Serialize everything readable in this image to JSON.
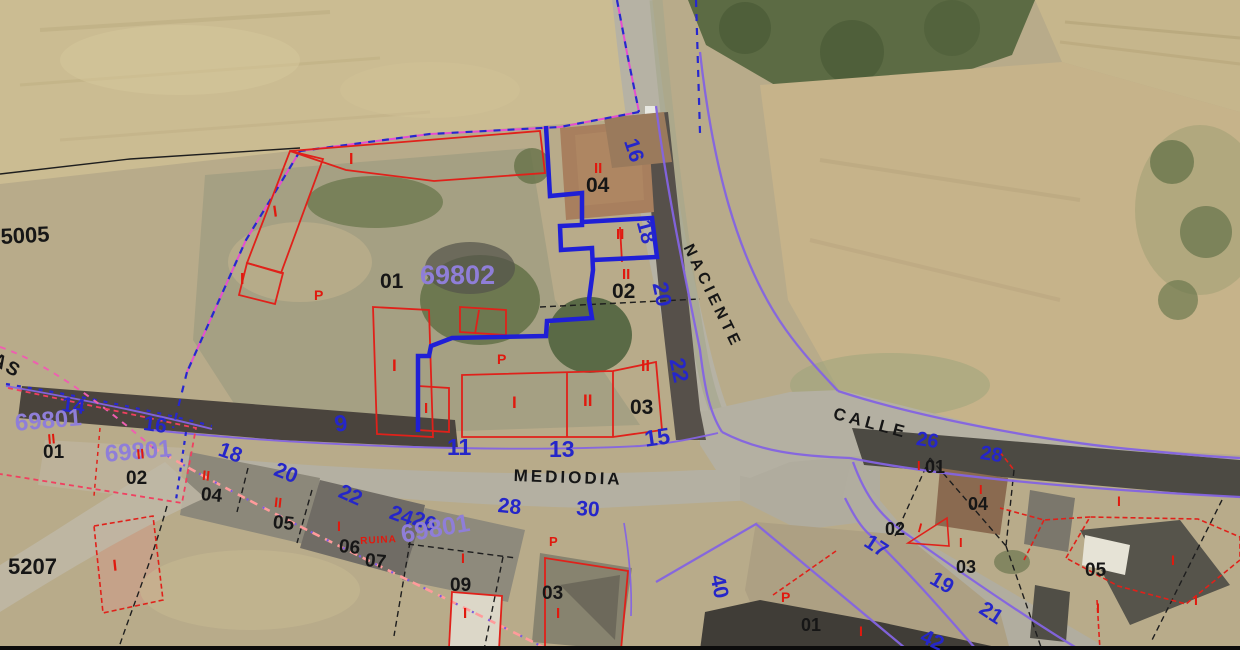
{
  "map": {
    "type": "cadastral-aerial-overlay",
    "palette": {
      "k": "#161616",
      "b": "#2526c9",
      "v": "#8f7ed8",
      "r": "#e0190e",
      "violet_line": "#8464e2",
      "blue_line": "#2727cf",
      "magenta_line": "#e54fd0",
      "pink_line": "#ff9b9b",
      "red_line": "#e0211a"
    },
    "labels": [
      {
        "n": "plot-number-5005",
        "t": "5005",
        "x": 0,
        "y": 226,
        "s": 22,
        "c": "k",
        "w": 600,
        "r": -3
      },
      {
        "n": "plot-number-5207",
        "t": "5207",
        "x": 8,
        "y": 556,
        "s": 22,
        "c": "k",
        "w": 600
      },
      {
        "n": "parcel-04-top",
        "t": "04",
        "x": 586,
        "y": 175,
        "s": 21,
        "c": "k",
        "w": 600
      },
      {
        "n": "parcel-02-top",
        "t": "02",
        "x": 612,
        "y": 281,
        "s": 21,
        "c": "k",
        "w": 600
      },
      {
        "n": "parcel-01-center",
        "t": "01",
        "x": 380,
        "y": 271,
        "s": 21,
        "c": "k",
        "w": 600
      },
      {
        "n": "parcel-03-center",
        "t": "03",
        "x": 630,
        "y": 397,
        "s": 21,
        "c": "k",
        "w": 600
      },
      {
        "n": "parcel-01-left",
        "t": "01",
        "x": 43,
        "y": 443,
        "s": 19,
        "c": "k",
        "w": 600
      },
      {
        "n": "parcel-02-left",
        "t": "02",
        "x": 126,
        "y": 469,
        "s": 19,
        "c": "k",
        "w": 600
      },
      {
        "n": "parcel-04-row",
        "t": "04",
        "x": 202,
        "y": 485,
        "s": 19,
        "c": "k",
        "w": 600,
        "r": 6
      },
      {
        "n": "parcel-05-row",
        "t": "05",
        "x": 274,
        "y": 513,
        "s": 19,
        "c": "k",
        "w": 600,
        "r": 6
      },
      {
        "n": "parcel-06-row",
        "t": "06",
        "x": 340,
        "y": 537,
        "s": 19,
        "c": "k",
        "w": 600,
        "r": 6
      },
      {
        "n": "parcel-07-row",
        "t": "07",
        "x": 366,
        "y": 551,
        "s": 19,
        "c": "k",
        "w": 600,
        "r": 6
      },
      {
        "n": "parcel-09-row",
        "t": "09",
        "x": 450,
        "y": 576,
        "s": 19,
        "c": "k",
        "w": 600
      },
      {
        "n": "parcel-03-row",
        "t": "03",
        "x": 542,
        "y": 584,
        "s": 19,
        "c": "k",
        "w": 600
      },
      {
        "n": "parcel-01-right",
        "t": "01",
        "x": 925,
        "y": 458,
        "s": 18,
        "c": "k",
        "w": 600
      },
      {
        "n": "parcel-04-right",
        "t": "04",
        "x": 968,
        "y": 495,
        "s": 18,
        "c": "k",
        "w": 600
      },
      {
        "n": "parcel-02-right",
        "t": "02",
        "x": 885,
        "y": 520,
        "s": 18,
        "c": "k",
        "w": 600
      },
      {
        "n": "parcel-03-right",
        "t": "03",
        "x": 956,
        "y": 558,
        "s": 18,
        "c": "k",
        "w": 600
      },
      {
        "n": "parcel-05-right",
        "t": "05",
        "x": 1085,
        "y": 561,
        "s": 19,
        "c": "k",
        "w": 600
      },
      {
        "n": "parcel-01-bottom",
        "t": "01",
        "x": 801,
        "y": 616,
        "s": 18,
        "c": "k",
        "w": 600
      },
      {
        "n": "street-name-naciente",
        "t": "NACIENTE",
        "x": 694,
        "y": 242,
        "s": 16,
        "c": "k",
        "w": 600,
        "r": 64,
        "ls": 4
      },
      {
        "n": "street-name-mediodia",
        "t": "MEDIODIA",
        "x": 514,
        "y": 467,
        "s": 17,
        "c": "k",
        "w": 600,
        "r": 2,
        "ls": 3
      },
      {
        "n": "street-name-calle",
        "t": "CALLE",
        "x": 836,
        "y": 405,
        "s": 17,
        "c": "k",
        "w": 600,
        "r": 15,
        "ls": 4
      },
      {
        "n": "street-name-partial",
        "t": "AS",
        "x": -2,
        "y": 350,
        "s": 19,
        "c": "k",
        "w": 600,
        "r": 30,
        "ls": 2
      },
      {
        "n": "house-number-16-naciente",
        "t": "16",
        "x": 640,
        "y": 136,
        "s": 21,
        "c": "b",
        "r": 72
      },
      {
        "n": "house-number-18-naciente",
        "t": "18",
        "x": 653,
        "y": 218,
        "s": 21,
        "c": "b",
        "r": 75
      },
      {
        "n": "house-number-20-naciente",
        "t": "20",
        "x": 670,
        "y": 280,
        "s": 22,
        "c": "b",
        "r": 78
      },
      {
        "n": "house-number-22-naciente",
        "t": "22",
        "x": 687,
        "y": 356,
        "s": 22,
        "c": "b",
        "r": 78
      },
      {
        "n": "house-number-9",
        "t": "9",
        "x": 333,
        "y": 413,
        "s": 23,
        "c": "b",
        "r": -8
      },
      {
        "n": "house-number-11",
        "t": "11",
        "x": 447,
        "y": 436,
        "s": 23,
        "c": "b"
      },
      {
        "n": "house-number-13",
        "t": "13",
        "x": 549,
        "y": 438,
        "s": 23,
        "c": "b"
      },
      {
        "n": "house-number-15",
        "t": "15",
        "x": 643,
        "y": 428,
        "s": 23,
        "c": "b",
        "r": -8
      },
      {
        "n": "house-number-14",
        "t": "14",
        "x": 63,
        "y": 394,
        "s": 21,
        "c": "b",
        "r": 8
      },
      {
        "n": "house-number-16-left",
        "t": "16",
        "x": 145,
        "y": 413,
        "s": 21,
        "c": "b",
        "r": 8
      },
      {
        "n": "house-number-18-row",
        "t": "18",
        "x": 223,
        "y": 439,
        "s": 21,
        "c": "b",
        "r": 20
      },
      {
        "n": "house-number-20-row",
        "t": "20",
        "x": 279,
        "y": 459,
        "s": 21,
        "c": "b",
        "r": 22
      },
      {
        "n": "house-number-22-row",
        "t": "22",
        "x": 344,
        "y": 481,
        "s": 21,
        "c": "b",
        "r": 24
      },
      {
        "n": "house-number-24",
        "t": "24",
        "x": 394,
        "y": 502,
        "s": 21,
        "c": "b",
        "r": 20
      },
      {
        "n": "house-number-26-row",
        "t": "26",
        "x": 417,
        "y": 508,
        "s": 21,
        "c": "b",
        "r": 20
      },
      {
        "n": "house-number-28-row",
        "t": "28",
        "x": 499,
        "y": 495,
        "s": 21,
        "c": "b",
        "r": 6
      },
      {
        "n": "house-number-30",
        "t": "30",
        "x": 577,
        "y": 498,
        "s": 21,
        "c": "b",
        "r": 4
      },
      {
        "n": "house-number-26-calle",
        "t": "26",
        "x": 918,
        "y": 429,
        "s": 20,
        "c": "b",
        "r": 9
      },
      {
        "n": "house-number-28-calle",
        "t": "28",
        "x": 982,
        "y": 443,
        "s": 20,
        "c": "b",
        "r": 9
      },
      {
        "n": "house-number-17",
        "t": "17",
        "x": 872,
        "y": 531,
        "s": 21,
        "c": "b",
        "r": 33
      },
      {
        "n": "house-number-19",
        "t": "19",
        "x": 937,
        "y": 568,
        "s": 21,
        "c": "b",
        "r": 30
      },
      {
        "n": "house-number-21",
        "t": "21",
        "x": 987,
        "y": 598,
        "s": 21,
        "c": "b",
        "r": 33
      },
      {
        "n": "house-number-40",
        "t": "40",
        "x": 727,
        "y": 573,
        "s": 21,
        "c": "b",
        "r": 78
      },
      {
        "n": "house-number-42",
        "t": "42",
        "x": 926,
        "y": 626,
        "s": 21,
        "c": "b",
        "r": 25
      },
      {
        "n": "block-number-69802",
        "t": "69802",
        "x": 420,
        "y": 262,
        "s": 27,
        "c": "v"
      },
      {
        "n": "block-number-69801-a",
        "t": "69801",
        "x": 14,
        "y": 412,
        "s": 24,
        "c": "v",
        "r": -5
      },
      {
        "n": "block-number-69801-b",
        "t": "69801",
        "x": 104,
        "y": 443,
        "s": 24,
        "c": "v",
        "r": -5
      },
      {
        "n": "block-number-69801-c",
        "t": "69801",
        "x": 399,
        "y": 523,
        "s": 25,
        "c": "v",
        "r": -10
      },
      {
        "n": "mark-p-1",
        "t": "P",
        "x": 314,
        "y": 288,
        "s": 14,
        "c": "r"
      },
      {
        "n": "mark-p-2",
        "t": "P",
        "x": 497,
        "y": 352,
        "s": 14,
        "c": "r"
      },
      {
        "n": "mark-p-3",
        "t": "P",
        "x": 549,
        "y": 535,
        "s": 13,
        "c": "r"
      },
      {
        "n": "mark-p-4",
        "t": "P",
        "x": 781,
        "y": 590,
        "s": 14,
        "c": "r"
      },
      {
        "n": "mark-ruina",
        "t": "RUINA",
        "x": 360,
        "y": 537,
        "s": 10,
        "c": "r",
        "r": -3,
        "ls": 1
      },
      {
        "n": "floors-ii-04top",
        "t": "II",
        "x": 594,
        "y": 161,
        "s": 15,
        "c": "r"
      },
      {
        "n": "floors-ii-02top",
        "t": "II",
        "x": 622,
        "y": 267,
        "s": 15,
        "c": "r"
      },
      {
        "n": "floors-ii-18box",
        "t": "II",
        "x": 616,
        "y": 227,
        "s": 15,
        "c": "r"
      },
      {
        "n": "floors-i-a",
        "t": "I",
        "x": 349,
        "y": 152,
        "s": 16,
        "c": "r"
      },
      {
        "n": "floors-i-b",
        "t": "I",
        "x": 272,
        "y": 205,
        "s": 16,
        "c": "r",
        "r": -8
      },
      {
        "n": "floors-i-c",
        "t": "I",
        "x": 240,
        "y": 272,
        "s": 16,
        "c": "r"
      },
      {
        "n": "floors-i-d",
        "t": "I",
        "x": 392,
        "y": 357,
        "s": 17,
        "c": "r"
      },
      {
        "n": "floors-i-e",
        "t": "I",
        "x": 424,
        "y": 401,
        "s": 15,
        "c": "r"
      },
      {
        "n": "floors-i-f",
        "t": "I",
        "x": 512,
        "y": 394,
        "s": 17,
        "c": "r"
      },
      {
        "n": "floors-ii-g",
        "t": "II",
        "x": 583,
        "y": 392,
        "s": 17,
        "c": "r"
      },
      {
        "n": "floors-ii-h",
        "t": "II",
        "x": 641,
        "y": 359,
        "s": 16,
        "c": "r"
      },
      {
        "n": "floors-ii-left01",
        "t": "II",
        "x": 47,
        "y": 432,
        "s": 14,
        "c": "r",
        "r": -5
      },
      {
        "n": "floors-ii-69801b",
        "t": "II",
        "x": 136,
        "y": 447,
        "s": 14,
        "c": "r",
        "r": -5
      },
      {
        "n": "floors-ii-row04",
        "t": "II",
        "x": 203,
        "y": 468,
        "s": 14,
        "c": "r",
        "r": 6
      },
      {
        "n": "floors-ii-row05",
        "t": "II",
        "x": 275,
        "y": 495,
        "s": 14,
        "c": "r",
        "r": 6
      },
      {
        "n": "floors-i-row06",
        "t": "I",
        "x": 337,
        "y": 519,
        "s": 14,
        "c": "r"
      },
      {
        "n": "floors-i-row09",
        "t": "I",
        "x": 461,
        "y": 551,
        "s": 14,
        "c": "r"
      },
      {
        "n": "floors-i-row03",
        "t": "I",
        "x": 556,
        "y": 606,
        "s": 15,
        "c": "r"
      },
      {
        "n": "floors-i-white-bldg",
        "t": "I",
        "x": 463,
        "y": 606,
        "s": 15,
        "c": "r"
      },
      {
        "n": "floors-i-5207",
        "t": "I",
        "x": 112,
        "y": 559,
        "s": 16,
        "c": "r",
        "r": -6
      },
      {
        "n": "floors-i-right01",
        "t": "I",
        "x": 917,
        "y": 459,
        "s": 13,
        "c": "r"
      },
      {
        "n": "floors-i-right04",
        "t": "I",
        "x": 979,
        "y": 483,
        "s": 13,
        "c": "r"
      },
      {
        "n": "floors-i-right02",
        "t": "I",
        "x": 920,
        "y": 521,
        "s": 13,
        "c": "r",
        "r": 15
      },
      {
        "n": "floors-i-right03",
        "t": "I",
        "x": 959,
        "y": 536,
        "s": 13,
        "c": "r"
      },
      {
        "n": "floors-i-field1",
        "t": "I",
        "x": 1117,
        "y": 494,
        "s": 14,
        "c": "r"
      },
      {
        "n": "floors-i-field2",
        "t": "I",
        "x": 1171,
        "y": 553,
        "s": 14,
        "c": "r"
      },
      {
        "n": "floors-i-field3",
        "t": "I",
        "x": 1096,
        "y": 601,
        "s": 14,
        "c": "r"
      },
      {
        "n": "floors-i-field4",
        "t": "I",
        "x": 1194,
        "y": 593,
        "s": 14,
        "c": "r"
      },
      {
        "n": "floors-i-bottom",
        "t": "I",
        "x": 859,
        "y": 624,
        "s": 14,
        "c": "r"
      }
    ]
  }
}
